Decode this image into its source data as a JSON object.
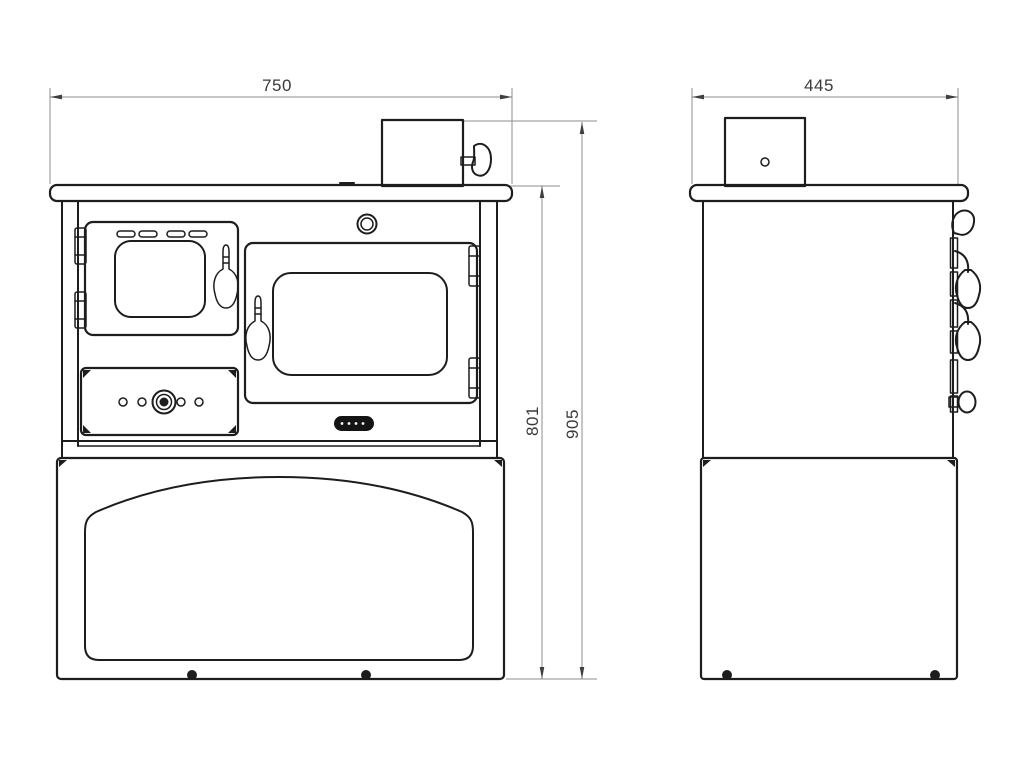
{
  "colors": {
    "background": "#ffffff",
    "outline": "#1d1d1d",
    "dimension_line": "#8c8c8c",
    "dimension_arrow": "#3f3f3f",
    "dimension_text": "#3a3a3a",
    "badge_fill": "#141414"
  },
  "dimensions": {
    "front_width": "750",
    "side_depth": "445",
    "height_to_cooktop": "801",
    "overall_height": "905"
  },
  "drawing": {
    "type": "technical dimension drawing",
    "subject": "solid-fuel cooking stove, front and side elevations",
    "front_view_features": [
      "top-plate",
      "flue-collar",
      "flue-damper-knob",
      "air-inlet-port",
      "oven-door",
      "oven-door-vents",
      "oven-door-window",
      "oven-door-handle",
      "oven-door-hinges",
      "control-panel",
      "thermostat-dial",
      "panel-holes",
      "firebox-door",
      "firebox-window",
      "firebox-handle",
      "firebox-hinges",
      "brand-badge",
      "wood-storage-compartment",
      "arched-drawer-panel",
      "feet"
    ],
    "side_view_features": [
      "top-plate",
      "flue-collar",
      "flue-pin-hole",
      "hinge-rail",
      "door-handles",
      "damper-knobs",
      "storage-compartment",
      "feet"
    ]
  }
}
